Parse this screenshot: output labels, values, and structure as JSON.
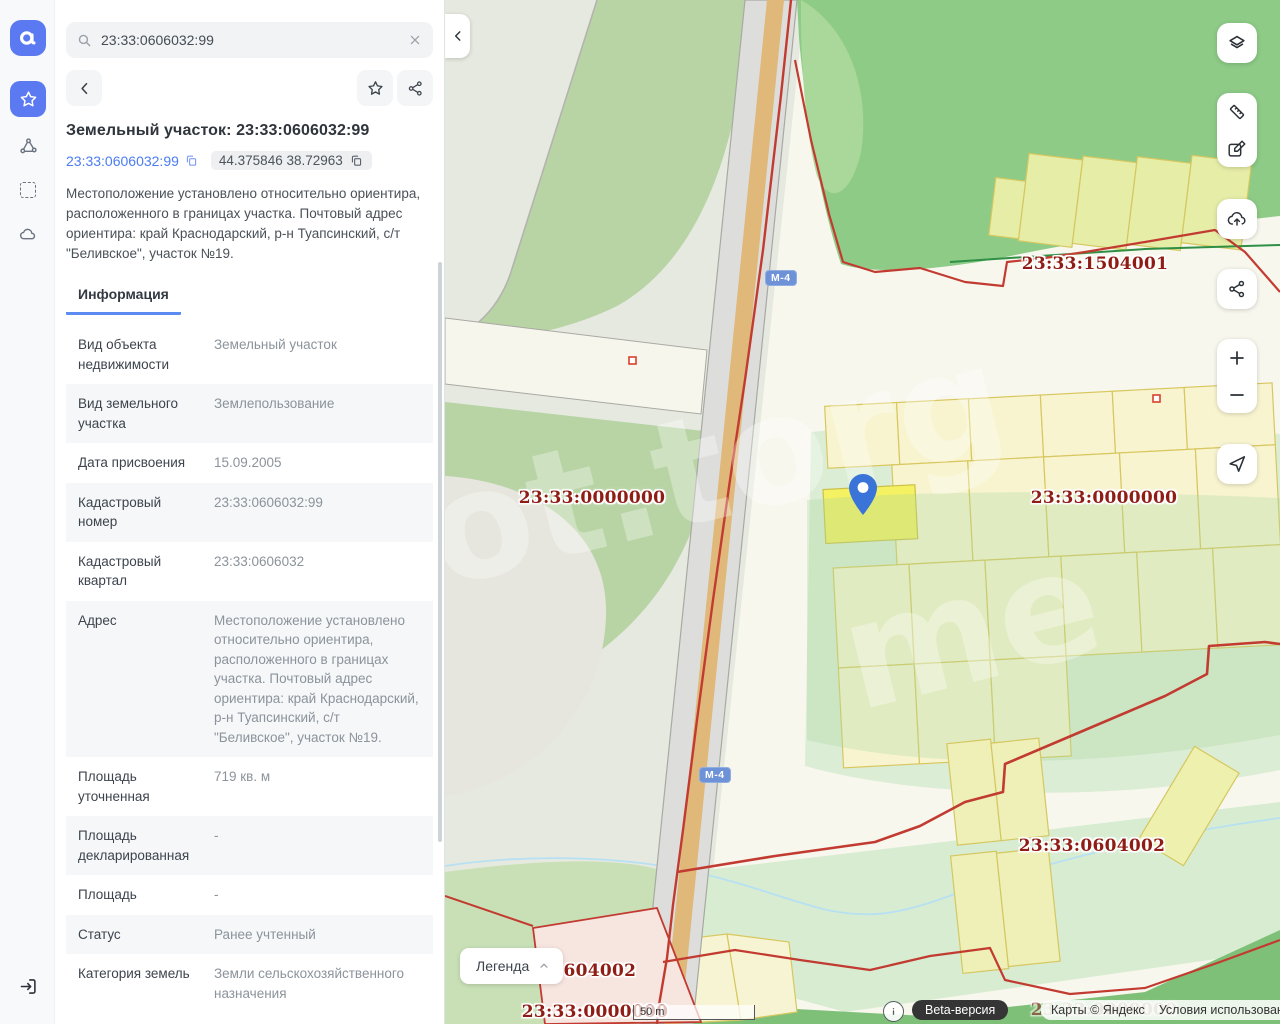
{
  "search": {
    "value": "23:33:0606032:99"
  },
  "panel": {
    "title": "Земельный участок: 23:33:0606032:99",
    "cadastral_link": "23:33:0606032:99",
    "coordinates": "44.375846 38.72963",
    "description": "Местоположение установлено относительно ориентира, расположенного в границах участка. Почтовый адрес ориентира: край Краснодарский, р-н Туапсинский, с/т \"Беливское\", участок №19.",
    "tab_label": "Информация",
    "info_rows": [
      {
        "label": "Вид объекта недвижимости",
        "value": "Земельный участок"
      },
      {
        "label": "Вид земельного участка",
        "value": "Землепользование"
      },
      {
        "label": "Дата присвоения",
        "value": "15.09.2005"
      },
      {
        "label": "Кадастровый номер",
        "value": "23:33:0606032:99"
      },
      {
        "label": "Кадастровый квартал",
        "value": "23:33:0606032"
      },
      {
        "label": "Адрес",
        "value": "Местоположение установлено относительно ориентира, расположенного в границах участка. Почтовый адрес ориентира: край Краснодарский, р-н Туапсинский, с/т \"Беливское\", участок №19."
      },
      {
        "label": "Площадь уточненная",
        "value": "719 кв. м"
      },
      {
        "label": "Площадь декларированная",
        "value": "-"
      },
      {
        "label": "Площадь",
        "value": "-"
      },
      {
        "label": "Статус",
        "value": "Ранее учтенный"
      },
      {
        "label": "Категория земель",
        "value": "Земли сельскохозяйственного назначения"
      }
    ]
  },
  "map": {
    "road_badge": "М-4",
    "legend_label": "Легенда",
    "scale_label": "50 m",
    "beta_label": "Beta-версия",
    "attribution": "Карты © Яндекс",
    "terms_label": "Условия использования",
    "watermark_a": "ot.torg",
    "watermark_b": "me",
    "labels": [
      {
        "text": "23:33:1504001"
      },
      {
        "text": "23:33:0000000"
      },
      {
        "text": "23:33:0000000"
      },
      {
        "text": "23:33:0604002"
      },
      {
        "text": "23:33:0604002"
      },
      {
        "text": "23:33:0000000"
      },
      {
        "text": "23:33:0000000"
      }
    ]
  },
  "colors": {
    "accent": "#5b79f0",
    "boundary_red": "#c23b31",
    "cadastral_label": "#8f1d15"
  }
}
